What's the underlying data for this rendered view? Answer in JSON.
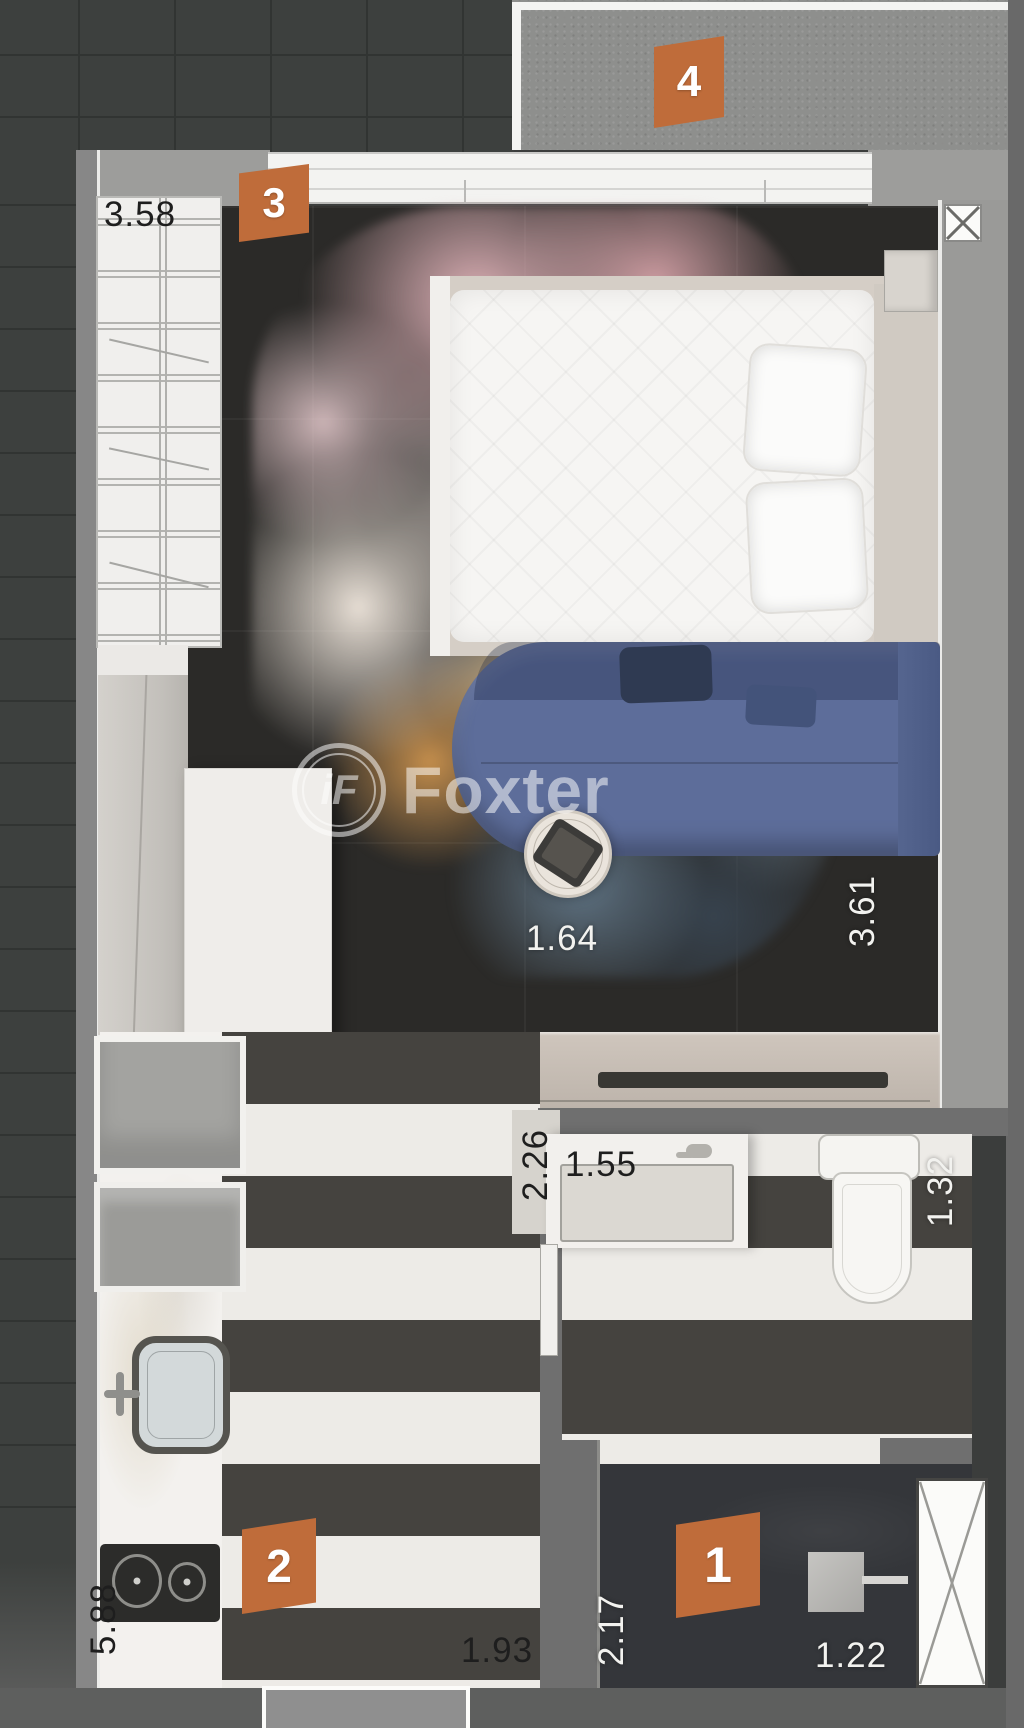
{
  "watermark": {
    "monogram": "iF",
    "name": "Foxter"
  },
  "markers": {
    "m1": "1",
    "m2": "2",
    "m3": "3",
    "m4": "4"
  },
  "measurements": {
    "closet_width": "3.58",
    "living_rug_width": "1.64",
    "living_depth": "3.61",
    "dining_depth": "2.26",
    "vanity_width": "1.55",
    "bathroom_width": "1.32",
    "kitchen_run_length": "5.88",
    "dining_width": "1.93",
    "hall_depth": "2.17",
    "hall_width": "1.22"
  },
  "icons": {
    "shaft_cross": "crossed-box",
    "duct_cross": "crossed-box"
  },
  "colors": {
    "marker_orange": "#bf6c3a",
    "sofa_blue": "#5d6d9a",
    "floor_dark": "#2b2a28",
    "balcony_concrete": "#8e8f8d",
    "stripe_dark": "#45433f",
    "stripe_light": "#edebe7",
    "rug_pink": "#e2b4ba",
    "rug_orange": "#db9d52"
  }
}
